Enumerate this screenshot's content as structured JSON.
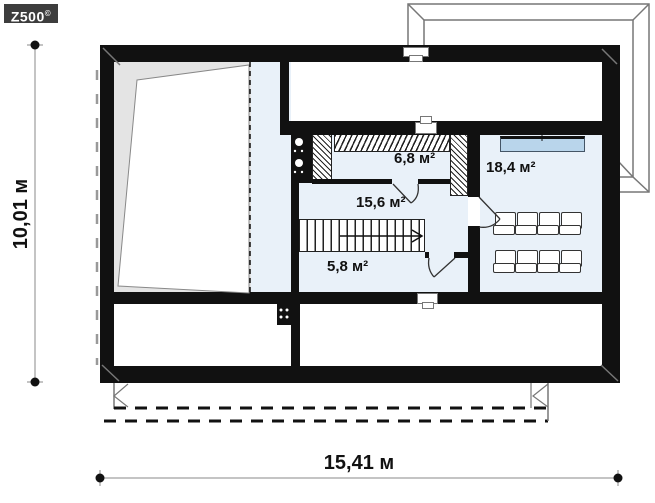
{
  "logo": {
    "text": "Z500",
    "mark": "©"
  },
  "plan_title": "attic-floor-plan",
  "dimensions": {
    "overall_width": "15,41 м",
    "overall_height": "10,01 м"
  },
  "rooms": {
    "wardrobe": {
      "area": "6,8 м²"
    },
    "hall": {
      "area": "15,6 м²"
    },
    "storage": {
      "area": "5,8 м²"
    },
    "cinema_room": {
      "area": "18,4 м²"
    }
  },
  "colors": {
    "wall": "#111111",
    "floor_blue": "#e9f1f9",
    "void_gray": "#e4e4e4",
    "roof_window_blue": "#b9d5eb",
    "outline_gray": "#777777",
    "logo_bg": "#3d3d3d"
  }
}
